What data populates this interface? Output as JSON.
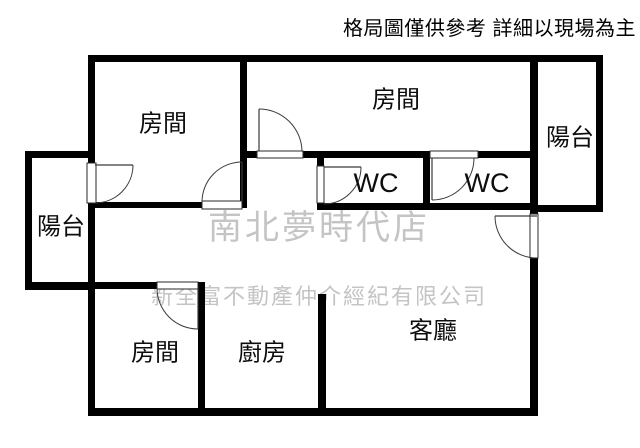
{
  "header": {
    "disclaimer": "格局圖僅供參考 詳細以現場為主"
  },
  "watermarks": {
    "store": {
      "text": "南北夢時代店",
      "x": 208,
      "y": 200,
      "font_size": 34,
      "letter_spacing": 3,
      "color": "#c4c4c4"
    },
    "company": {
      "text": "新全富不動產仲介經紀有限公司",
      "x": 151,
      "y": 279,
      "font_size": 22,
      "letter_spacing": 2,
      "color": "#c4c4c4"
    }
  },
  "floorplan": {
    "canvas": {
      "width": 640,
      "height": 448,
      "background": "#ffffff"
    },
    "wall_color": "#000000",
    "door_color": "#3a3a3a",
    "frame_color": "#2a2a2a",
    "label_color": "#0d0d0d",
    "walls": [
      [
        88,
        55,
        515,
        7
      ],
      [
        596,
        55,
        7,
        157
      ],
      [
        530,
        205,
        73,
        7
      ],
      [
        530,
        55,
        8,
        150
      ],
      [
        530,
        212,
        8,
        3
      ],
      [
        530,
        258,
        8,
        158
      ],
      [
        88,
        55,
        7,
        108
      ],
      [
        88,
        203,
        7,
        213
      ],
      [
        25,
        151,
        7,
        139
      ],
      [
        25,
        151,
        70,
        7
      ],
      [
        25,
        282,
        70,
        8
      ],
      [
        88,
        202,
        114,
        6
      ],
      [
        242,
        202,
        5,
        6
      ],
      [
        240,
        55,
        7,
        153
      ],
      [
        247,
        151,
        10,
        7
      ],
      [
        303,
        151,
        127,
        7
      ],
      [
        478,
        151,
        60,
        7
      ],
      [
        423,
        158,
        7,
        45
      ],
      [
        317,
        158,
        7,
        9
      ],
      [
        317,
        203,
        221,
        7
      ],
      [
        88,
        282,
        69,
        7
      ],
      [
        198,
        282,
        7,
        134
      ],
      [
        318,
        294,
        8,
        122
      ],
      [
        88,
        408,
        450,
        8
      ]
    ],
    "door_openings": [
      {
        "name": "balcony-left-door",
        "x": 87,
        "y": 163,
        "w": 9,
        "h": 40
      },
      {
        "name": "bedroom-1-door",
        "x": 202,
        "y": 201,
        "w": 40,
        "h": 8
      },
      {
        "name": "bedroom-2-door",
        "x": 257,
        "y": 151,
        "w": 46,
        "h": 7
      },
      {
        "name": "wc-1-door",
        "x": 317,
        "y": 166,
        "w": 7,
        "h": 37
      },
      {
        "name": "wc-2-door",
        "x": 430,
        "y": 151,
        "w": 48,
        "h": 7
      },
      {
        "name": "entry-door",
        "x": 530,
        "y": 214,
        "w": 8,
        "h": 44
      },
      {
        "name": "bedroom-3-door",
        "x": 157,
        "y": 282,
        "w": 41,
        "h": 7
      }
    ],
    "doors": [
      {
        "name": "balcony-left-door",
        "leaf": [
          95,
          165,
          133,
          165
        ],
        "arc": "M 133 165 A 38 38 0 0 1 95 203"
      },
      {
        "name": "bedroom-1-door",
        "leaf": [
          242,
          202,
          242,
          162
        ],
        "arc": "M 242 162 A 40 40 0 0 0 202 202"
      },
      {
        "name": "bedroom-2-door",
        "leaf": [
          259,
          151,
          259,
          109
        ],
        "arc": "M 259 109 A 43 43 0 0 1 302 151"
      },
      {
        "name": "wc-1-door",
        "leaf": [
          324,
          167,
          361,
          167
        ],
        "arc": "M 361 167 A 37 37 0 0 1 324 204"
      },
      {
        "name": "wc-2-door",
        "leaf": [
          432,
          158,
          432,
          200
        ],
        "arc": "M 432 200 A 42 42 0 0 0 474 158"
      },
      {
        "name": "entry-door",
        "leaf": [
          537,
          216,
          495,
          216
        ],
        "arc": "M 495 216 A 42 42 0 0 0 537 258"
      },
      {
        "name": "bedroom-3-door",
        "leaf": [
          198,
          288,
          198,
          329
        ],
        "arc": "M 198 329 A 41 41 0 0 1 157 288"
      }
    ],
    "rooms": [
      {
        "name": "bedroom-1",
        "label": "房間",
        "cx": 163,
        "cy": 124,
        "font_size": 24
      },
      {
        "name": "bedroom-2",
        "label": "房間",
        "cx": 396,
        "cy": 100,
        "font_size": 24
      },
      {
        "name": "balcony-right",
        "label": "陽台",
        "cx": 570,
        "cy": 138,
        "font_size": 24
      },
      {
        "name": "wc-1",
        "label": "WC",
        "cx": 376,
        "cy": 183,
        "font_size": 27
      },
      {
        "name": "wc-2",
        "label": "WC",
        "cx": 487,
        "cy": 183,
        "font_size": 27
      },
      {
        "name": "balcony-left",
        "label": "陽台",
        "cx": 61,
        "cy": 227,
        "font_size": 24
      },
      {
        "name": "bedroom-3",
        "label": "房間",
        "cx": 155,
        "cy": 353,
        "font_size": 24
      },
      {
        "name": "kitchen",
        "label": "廚房",
        "cx": 262,
        "cy": 353,
        "font_size": 24
      },
      {
        "name": "living-room",
        "label": "客廳",
        "cx": 433,
        "cy": 331,
        "font_size": 24
      }
    ]
  }
}
